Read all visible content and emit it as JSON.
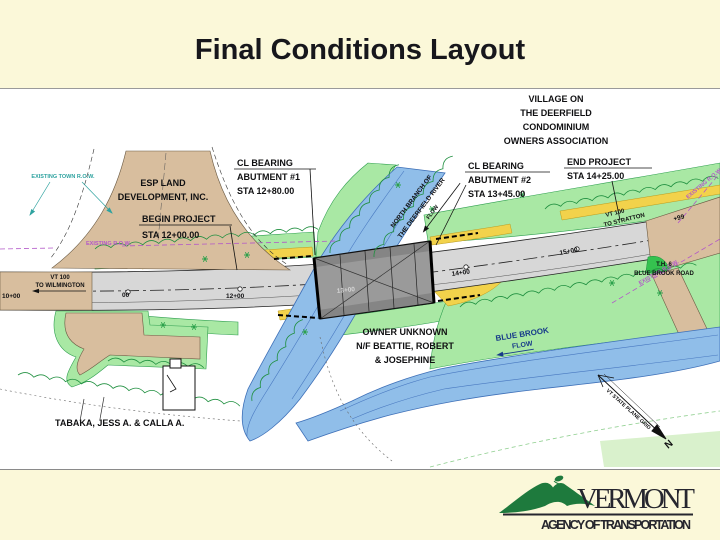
{
  "slide": {
    "title": "Final Conditions Layout"
  },
  "map": {
    "owners": {
      "village": [
        "VILLAGE ON",
        "THE DEERFIELD",
        "CONDOMINIUM",
        "OWNERS ASSOCIATION"
      ],
      "esp": [
        "ESP LAND",
        "DEVELOPMENT, INC."
      ],
      "owner_unknown": [
        "OWNER UNKNOWN",
        "N/F BEATTIE, ROBERT",
        "& JOSEPHINE"
      ],
      "tabaka": "TABAKA, JESS A. & CALLA A."
    },
    "callouts": {
      "abutment1": [
        "CL BEARING",
        "ABUTMENT #1",
        "STA 12+80.00"
      ],
      "abutment2": [
        "CL  BEARING",
        "ABUTMENT #2",
        "STA 13+45.00"
      ],
      "begin_project": [
        "BEGIN PROJECT",
        "STA 12+00.00"
      ],
      "end_project": [
        "END PROJECT",
        "STA 14+25.00"
      ]
    },
    "row": {
      "existing_town": "EXISTING TOWN R.O.W.",
      "existing_left": "EXISTING R.O.W.",
      "existing_right": "EXISTING R.O.W."
    },
    "water": {
      "river": [
        "NORTH BRANCH OF",
        "THE DEERFIELD RIVER",
        "FLOW"
      ],
      "brook": [
        "BLUE BROOK",
        "FLOW"
      ]
    },
    "roads": {
      "left": [
        "VT 100",
        "TO WILMINGTON"
      ],
      "right": [
        "VT 100",
        "TO STRATTON"
      ],
      "brook_road": [
        "T.H. 6",
        "BLUE BROOK ROAD"
      ]
    },
    "stations": {
      "s10": "10+00",
      "s11": "00",
      "s12": "12+00",
      "s13": "13+00",
      "s14": "14+00",
      "s15": "15+00",
      "s16": "+99"
    },
    "north": {
      "grid": "VT STATE PLANE GRID",
      "n": "N"
    }
  },
  "logo": {
    "state": "VERMONT",
    "agency": "AGENCY OF TRANSPORTATION"
  },
  "colors": {
    "background": "#FBF8D9",
    "title_text": "#17171C",
    "river_blue": "#90BEE9",
    "vegetation_green": "#A9E8A4",
    "pavement_new_gray": "#D7D7D7",
    "pavement_existing_tan": "#D8BE9E",
    "bridge_gray": "#858585",
    "shoulder_yellow": "#F2D24B",
    "row_purple": "#B257C8",
    "town_row_teal": "#2FA3A0",
    "logo_green": "#1E7A3D"
  }
}
